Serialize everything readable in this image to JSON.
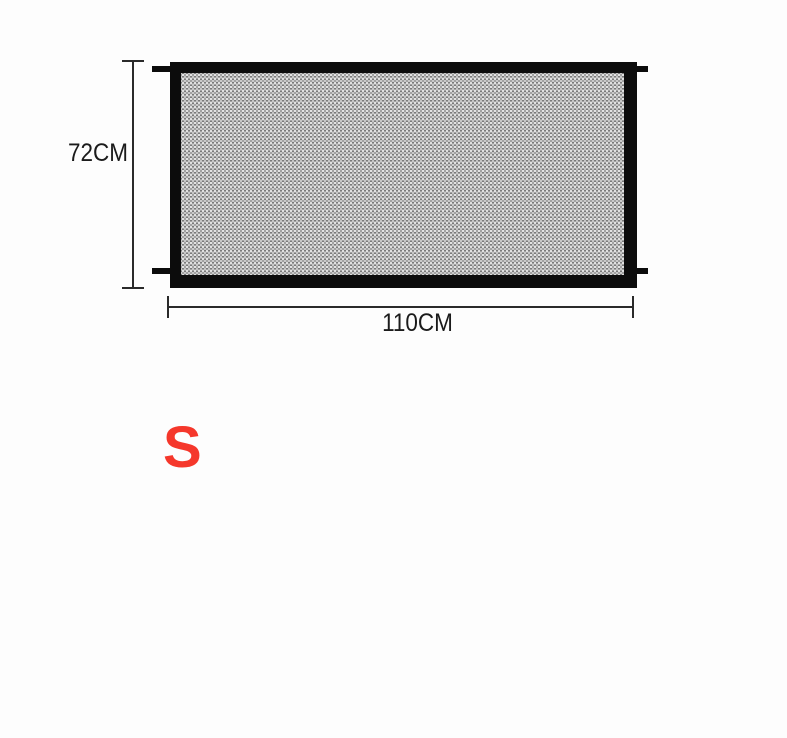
{
  "diagram": {
    "height_label": "72CM",
    "width_label": "110CM",
    "size_label": "S",
    "colors": {
      "frame_black": "#0c0c0c",
      "mesh_gray": "#a0a0a0",
      "dimension_line": "#2a2a2a",
      "label_text": "#1b1b1b",
      "size_label_red": "#f5372b",
      "background": "#fdfdfd"
    }
  }
}
